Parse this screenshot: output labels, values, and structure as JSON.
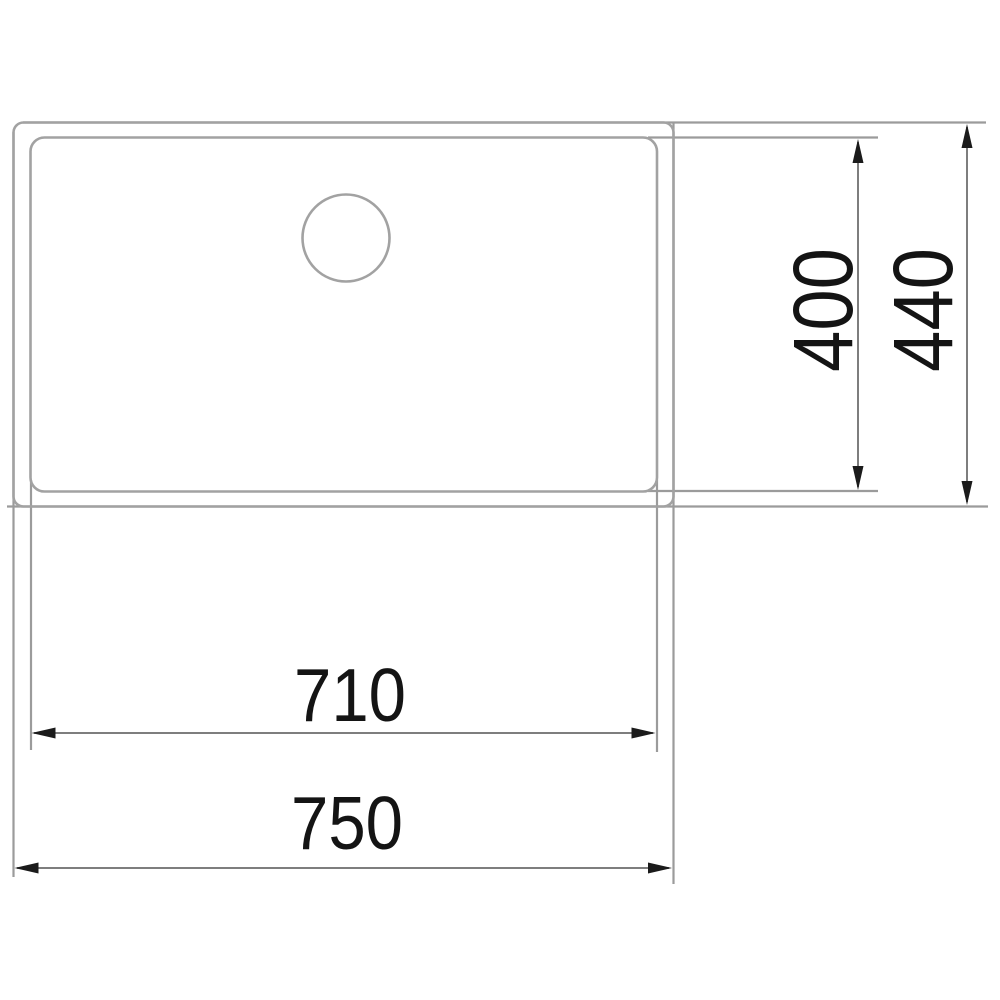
{
  "drawing": {
    "type": "sink-dimension-drawing",
    "labels": {
      "inner_depth": "400",
      "outer_depth": "440",
      "inner_width": "710",
      "outer_width": "750"
    },
    "colors": {
      "object_line": "#a2a2a2",
      "extension_line": "#9b9b9b",
      "dimension_line": "#7e7e7e",
      "arrow_and_text": "#141414",
      "background": "#ffffff"
    }
  }
}
